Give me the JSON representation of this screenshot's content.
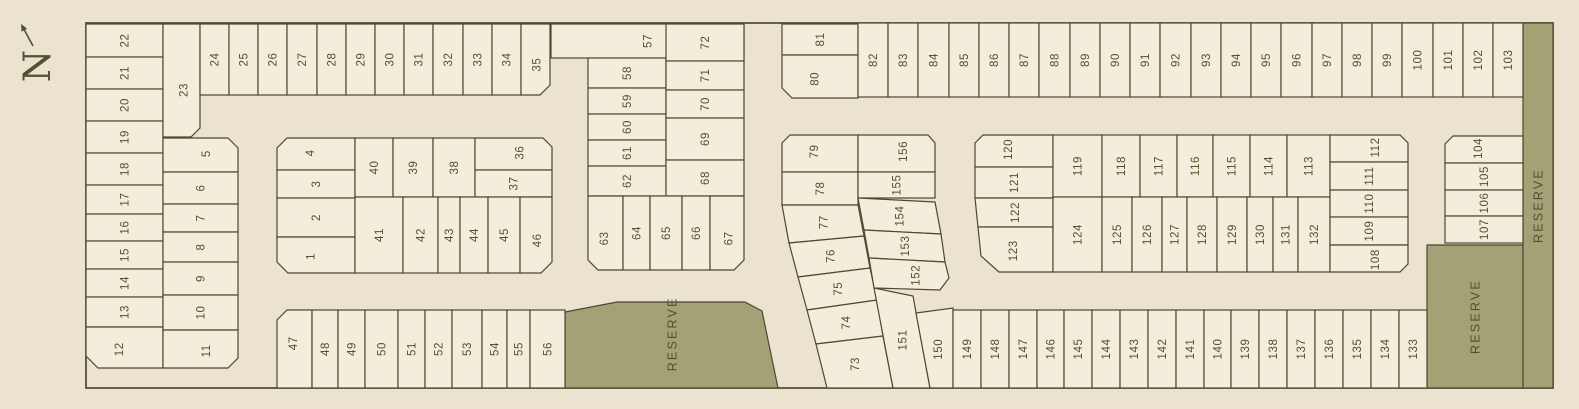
{
  "map": {
    "compass": {
      "label": "N"
    },
    "colors": {
      "background": "#ebe2cf",
      "lot_fill": "#f4eddc",
      "reserve_fill": "#a3a276",
      "line": "#4a4a2e",
      "text": "#4e5330"
    },
    "boundary": {
      "x": 86,
      "y": 23,
      "w": 1467,
      "h": 365
    },
    "reserves": [
      {
        "label": "RESERVE",
        "p": "565,312 617,302 745,302 762,311 778,388 565,388"
      },
      {
        "label": "RESERVE",
        "p": "1427,245 1523,245 1523,388 1427,388"
      },
      {
        "label": "RESERVE",
        "p": "1523,23 1553,23 1553,388 1523,388"
      }
    ],
    "lots": [
      {
        "n": "22",
        "r": [
          86,
          24,
          77,
          33
        ]
      },
      {
        "n": "21",
        "r": [
          86,
          57,
          77,
          32
        ]
      },
      {
        "n": "20",
        "r": [
          86,
          89,
          77,
          32
        ]
      },
      {
        "n": "19",
        "r": [
          86,
          121,
          77,
          32
        ]
      },
      {
        "n": "18",
        "r": [
          86,
          153,
          77,
          32
        ]
      },
      {
        "n": "17",
        "r": [
          86,
          185,
          77,
          29
        ]
      },
      {
        "n": "16",
        "r": [
          86,
          214,
          77,
          27
        ]
      },
      {
        "n": "15",
        "r": [
          86,
          241,
          77,
          28
        ]
      },
      {
        "n": "14",
        "r": [
          86,
          269,
          77,
          28
        ]
      },
      {
        "n": "13",
        "r": [
          86,
          297,
          77,
          30
        ]
      },
      {
        "n": "12",
        "p": "86,327 163,327 163,368 98,368 86,356"
      },
      {
        "n": "23",
        "p": "163,24 200,24 200,128 191,137 163,137"
      },
      {
        "n": "5",
        "p": "163,138 228,138 238,148 238,172 163,172"
      },
      {
        "n": "6",
        "r": [
          163,
          172,
          75,
          32
        ]
      },
      {
        "n": "7",
        "r": [
          163,
          204,
          75,
          28
        ]
      },
      {
        "n": "8",
        "r": [
          163,
          232,
          75,
          30
        ]
      },
      {
        "n": "9",
        "r": [
          163,
          262,
          75,
          33
        ]
      },
      {
        "n": "10",
        "r": [
          163,
          295,
          75,
          35
        ]
      },
      {
        "n": "11",
        "p": "163,330 238,330 238,358 228,368 163,368"
      },
      {
        "n": "24",
        "r": [
          200,
          24,
          29,
          71
        ]
      },
      {
        "n": "25",
        "r": [
          229,
          24,
          29,
          71
        ]
      },
      {
        "n": "26",
        "r": [
          258,
          24,
          29,
          71
        ]
      },
      {
        "n": "27",
        "r": [
          287,
          24,
          30,
          71
        ]
      },
      {
        "n": "28",
        "r": [
          317,
          24,
          29,
          71
        ]
      },
      {
        "n": "29",
        "r": [
          346,
          24,
          29,
          71
        ]
      },
      {
        "n": "30",
        "r": [
          375,
          24,
          29,
          71
        ]
      },
      {
        "n": "31",
        "r": [
          404,
          24,
          29,
          71
        ]
      },
      {
        "n": "32",
        "r": [
          433,
          24,
          30,
          71
        ]
      },
      {
        "n": "33",
        "r": [
          463,
          24,
          29,
          71
        ]
      },
      {
        "n": "34",
        "r": [
          492,
          24,
          29,
          71
        ]
      },
      {
        "n": "35",
        "p": "521,24 550,24 550,85 540,95 521,95"
      },
      {
        "n": "4",
        "p": "277,148 287,138 355,138 355,170 277,170"
      },
      {
        "n": "3",
        "r": [
          277,
          170,
          78,
          28
        ]
      },
      {
        "n": "2",
        "r": [
          277,
          198,
          78,
          39
        ]
      },
      {
        "n": "1",
        "p": "277,237 355,237 355,273 288,273 277,262"
      },
      {
        "n": "40",
        "r": [
          355,
          138,
          38,
          59
        ]
      },
      {
        "n": "39",
        "r": [
          393,
          138,
          40,
          59
        ]
      },
      {
        "n": "38",
        "r": [
          433,
          138,
          42,
          59
        ]
      },
      {
        "n": "36",
        "p": "475,138 543,138 552,147 552,170 475,170"
      },
      {
        "n": "37",
        "r": [
          475,
          170,
          77,
          27
        ]
      },
      {
        "n": "41",
        "r": [
          355,
          197,
          48,
          76
        ]
      },
      {
        "n": "42",
        "r": [
          403,
          197,
          35,
          76
        ]
      },
      {
        "n": "43",
        "r": [
          438,
          197,
          22,
          76
        ]
      },
      {
        "n": "44",
        "r": [
          460,
          197,
          28,
          76
        ]
      },
      {
        "n": "45",
        "r": [
          488,
          197,
          32,
          76
        ]
      },
      {
        "n": "46",
        "p": "520,197 552,197 552,262 541,273 520,273"
      },
      {
        "n": "47",
        "p": "277,320 287,310 312,310 312,388 277,388"
      },
      {
        "n": "48",
        "r": [
          312,
          310,
          26,
          78
        ]
      },
      {
        "n": "49",
        "r": [
          338,
          310,
          27,
          78
        ]
      },
      {
        "n": "50",
        "r": [
          365,
          310,
          33,
          78
        ]
      },
      {
        "n": "51",
        "r": [
          398,
          310,
          27,
          78
        ]
      },
      {
        "n": "52",
        "r": [
          425,
          310,
          27,
          78
        ]
      },
      {
        "n": "53",
        "r": [
          452,
          310,
          30,
          78
        ]
      },
      {
        "n": "54",
        "r": [
          482,
          310,
          25,
          78
        ]
      },
      {
        "n": "55",
        "r": [
          507,
          310,
          23,
          78
        ]
      },
      {
        "n": "56",
        "r": [
          530,
          310,
          35,
          78
        ]
      },
      {
        "n": "57",
        "r": [
          551,
          24,
          193,
          34
        ]
      },
      {
        "n": "58",
        "r": [
          588,
          58,
          78,
          30
        ]
      },
      {
        "n": "59",
        "r": [
          588,
          88,
          78,
          26
        ]
      },
      {
        "n": "60",
        "r": [
          588,
          114,
          78,
          26
        ]
      },
      {
        "n": "61",
        "r": [
          588,
          140,
          78,
          26
        ]
      },
      {
        "n": "62",
        "r": [
          588,
          166,
          78,
          30
        ]
      },
      {
        "n": "72",
        "r": [
          666,
          24,
          78,
          37
        ]
      },
      {
        "n": "71",
        "r": [
          666,
          61,
          78,
          29
        ]
      },
      {
        "n": "70",
        "r": [
          666,
          90,
          78,
          28
        ]
      },
      {
        "n": "69",
        "r": [
          666,
          118,
          78,
          42
        ]
      },
      {
        "n": "68",
        "r": [
          666,
          160,
          78,
          36
        ]
      },
      {
        "n": "63",
        "p": "588,196 623,196 623,270 598,270 588,260"
      },
      {
        "n": "64",
        "r": [
          623,
          196,
          27,
          74
        ]
      },
      {
        "n": "65",
        "r": [
          650,
          196,
          32,
          74
        ]
      },
      {
        "n": "66",
        "r": [
          682,
          196,
          28,
          74
        ]
      },
      {
        "n": "67",
        "p": "710,196 744,196 744,260 734,270 710,270"
      },
      {
        "n": "81",
        "r": [
          782,
          24,
          76,
          31
        ]
      },
      {
        "n": "80",
        "p": "782,55 858,55 858,98 792,98 782,88"
      },
      {
        "n": "79",
        "p": "782,143 790,135 858,135 858,172 782,172"
      },
      {
        "n": "78",
        "r": [
          782,
          172,
          76,
          33
        ]
      },
      {
        "n": "77",
        "p": "782,205 858,205 864,236 789,243"
      },
      {
        "n": "76",
        "p": "789,243 864,236 870,268 798,277"
      },
      {
        "n": "75",
        "p": "798,277 870,268 877,300 807,310"
      },
      {
        "n": "74",
        "p": "807,310 877,300 883,336 816,344"
      },
      {
        "n": "73",
        "p": "816,344 883,336 893,388 827,388"
      },
      {
        "n": "156",
        "p": "858,135 928,135 935,143 935,172 858,172"
      },
      {
        "n": "155",
        "r": [
          858,
          172,
          77,
          26
        ]
      },
      {
        "n": "154",
        "p": "858,198 935,202 941,234 864,230"
      },
      {
        "n": "153",
        "p": "864,230 941,234 945,262 869,258"
      },
      {
        "n": "152",
        "p": "869,258 945,262 949,278 940,290 874,288"
      },
      {
        "n": "151",
        "p": "874,288 913,296 930,388 893,388"
      },
      {
        "n": "150",
        "p": "916,313 953,308 953,388 930,388"
      },
      {
        "n": "149",
        "r": [
          953,
          310,
          28,
          78
        ]
      },
      {
        "n": "148",
        "r": [
          981,
          310,
          28,
          78
        ]
      },
      {
        "n": "147",
        "r": [
          1009,
          310,
          28,
          78
        ]
      },
      {
        "n": "146",
        "r": [
          1037,
          310,
          27,
          78
        ]
      },
      {
        "n": "145",
        "r": [
          1064,
          310,
          28,
          78
        ]
      },
      {
        "n": "144",
        "r": [
          1092,
          310,
          28,
          78
        ]
      },
      {
        "n": "143",
        "r": [
          1120,
          310,
          28,
          78
        ]
      },
      {
        "n": "142",
        "r": [
          1148,
          310,
          28,
          78
        ]
      },
      {
        "n": "141",
        "r": [
          1176,
          310,
          28,
          78
        ]
      },
      {
        "n": "140",
        "r": [
          1204,
          310,
          27,
          78
        ]
      },
      {
        "n": "139",
        "r": [
          1231,
          310,
          28,
          78
        ]
      },
      {
        "n": "138",
        "r": [
          1259,
          310,
          28,
          78
        ]
      },
      {
        "n": "137",
        "r": [
          1287,
          310,
          28,
          78
        ]
      },
      {
        "n": "136",
        "r": [
          1315,
          310,
          28,
          78
        ]
      },
      {
        "n": "135",
        "r": [
          1343,
          310,
          28,
          78
        ]
      },
      {
        "n": "134",
        "r": [
          1371,
          310,
          28,
          78
        ]
      },
      {
        "n": "133",
        "r": [
          1399,
          310,
          28,
          78
        ]
      },
      {
        "n": "82",
        "r": [
          858,
          23,
          30,
          74
        ]
      },
      {
        "n": "83",
        "r": [
          888,
          23,
          30,
          74
        ]
      },
      {
        "n": "84",
        "r": [
          918,
          23,
          31,
          74
        ]
      },
      {
        "n": "85",
        "r": [
          949,
          23,
          30,
          74
        ]
      },
      {
        "n": "86",
        "r": [
          979,
          23,
          30,
          74
        ]
      },
      {
        "n": "87",
        "r": [
          1009,
          23,
          30,
          74
        ]
      },
      {
        "n": "88",
        "r": [
          1039,
          23,
          31,
          74
        ]
      },
      {
        "n": "89",
        "r": [
          1070,
          23,
          30,
          74
        ]
      },
      {
        "n": "90",
        "r": [
          1100,
          23,
          30,
          74
        ]
      },
      {
        "n": "91",
        "r": [
          1130,
          23,
          30,
          74
        ]
      },
      {
        "n": "92",
        "r": [
          1160,
          23,
          31,
          74
        ]
      },
      {
        "n": "93",
        "r": [
          1191,
          23,
          30,
          74
        ]
      },
      {
        "n": "94",
        "r": [
          1221,
          23,
          30,
          74
        ]
      },
      {
        "n": "95",
        "r": [
          1251,
          23,
          30,
          74
        ]
      },
      {
        "n": "96",
        "r": [
          1281,
          23,
          31,
          74
        ]
      },
      {
        "n": "97",
        "r": [
          1312,
          23,
          30,
          74
        ]
      },
      {
        "n": "98",
        "r": [
          1342,
          23,
          30,
          74
        ]
      },
      {
        "n": "99",
        "r": [
          1372,
          23,
          30,
          74
        ]
      },
      {
        "n": "100",
        "r": [
          1402,
          23,
          31,
          74
        ]
      },
      {
        "n": "101",
        "r": [
          1433,
          23,
          30,
          74
        ]
      },
      {
        "n": "102",
        "r": [
          1463,
          23,
          30,
          74
        ]
      },
      {
        "n": "103",
        "r": [
          1493,
          23,
          30,
          74
        ]
      },
      {
        "n": "120",
        "p": "975,143 983,135 1053,135 1053,167 975,167"
      },
      {
        "n": "121",
        "r": [
          975,
          167,
          78,
          31
        ]
      },
      {
        "n": "122",
        "p": "975,198 1053,198 1053,227 978,227"
      },
      {
        "n": "123",
        "p": "978,227 1053,227 1053,272 999,272 981,256"
      },
      {
        "n": "119",
        "r": [
          1053,
          135,
          49,
          62
        ]
      },
      {
        "n": "118",
        "r": [
          1102,
          135,
          38,
          62
        ]
      },
      {
        "n": "117",
        "r": [
          1140,
          135,
          37,
          62
        ]
      },
      {
        "n": "116",
        "r": [
          1177,
          135,
          36,
          62
        ]
      },
      {
        "n": "115",
        "r": [
          1213,
          135,
          37,
          62
        ]
      },
      {
        "n": "114",
        "r": [
          1250,
          135,
          37,
          62
        ]
      },
      {
        "n": "113",
        "r": [
          1287,
          135,
          43,
          62
        ]
      },
      {
        "n": "124",
        "r": [
          1053,
          197,
          49,
          75
        ]
      },
      {
        "n": "125",
        "r": [
          1102,
          197,
          30,
          75
        ]
      },
      {
        "n": "126",
        "r": [
          1132,
          197,
          30,
          75
        ]
      },
      {
        "n": "127",
        "r": [
          1162,
          197,
          25,
          75
        ]
      },
      {
        "n": "128",
        "r": [
          1187,
          197,
          30,
          75
        ]
      },
      {
        "n": "129",
        "r": [
          1217,
          197,
          30,
          75
        ]
      },
      {
        "n": "130",
        "r": [
          1247,
          197,
          26,
          75
        ]
      },
      {
        "n": "131",
        "r": [
          1273,
          197,
          25,
          75
        ]
      },
      {
        "n": "132",
        "r": [
          1298,
          197,
          32,
          75
        ]
      },
      {
        "n": "112",
        "p": "1330,135 1400,135 1408,143 1408,162 1330,162"
      },
      {
        "n": "111",
        "r": [
          1330,
          162,
          78,
          28
        ]
      },
      {
        "n": "110",
        "r": [
          1330,
          190,
          78,
          27
        ]
      },
      {
        "n": "109",
        "r": [
          1330,
          217,
          78,
          28
        ]
      },
      {
        "n": "108",
        "p": "1330,245 1408,245 1408,264 1400,272 1330,272"
      },
      {
        "n": "104",
        "p": "1445,144 1453,136 1523,136 1523,163 1445,163"
      },
      {
        "n": "105",
        "r": [
          1445,
          163,
          78,
          27
        ]
      },
      {
        "n": "106",
        "r": [
          1445,
          190,
          78,
          26
        ]
      },
      {
        "n": "107",
        "r": [
          1445,
          216,
          78,
          27
        ]
      }
    ]
  }
}
